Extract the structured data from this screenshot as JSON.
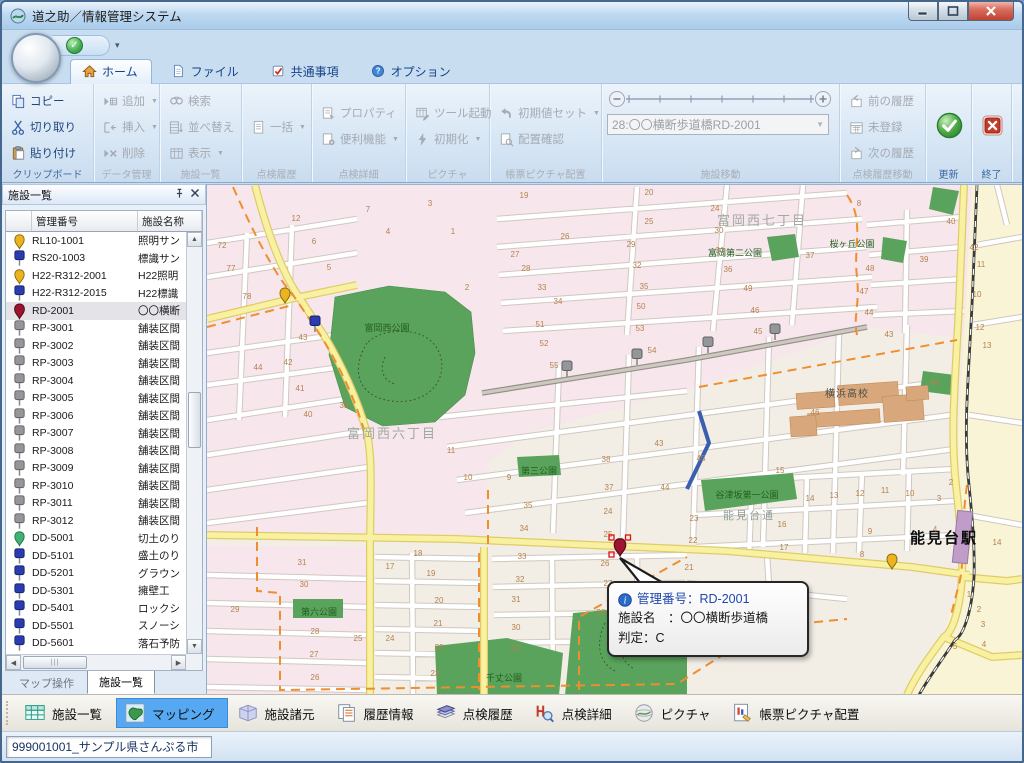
{
  "window": {
    "title": "道之助／情報管理システム"
  },
  "tabs": [
    {
      "label": "ホーム",
      "active": true
    },
    {
      "label": "ファイル",
      "active": false
    },
    {
      "label": "共通事項",
      "active": false
    },
    {
      "label": "オプション",
      "active": false
    }
  ],
  "ribbon": {
    "groups": [
      {
        "label": "クリップボード",
        "enabled": true,
        "buttons": [
          {
            "label": "コピー"
          },
          {
            "label": "切り取り"
          },
          {
            "label": "貼り付け"
          }
        ]
      },
      {
        "label": "データ管理",
        "enabled": false,
        "buttons": [
          {
            "label": "追加",
            "dropdown": true
          },
          {
            "label": "挿入",
            "dropdown": true
          },
          {
            "label": "削除"
          }
        ]
      },
      {
        "label": "施設一覧",
        "enabled": false,
        "buttons": [
          {
            "label": "検索"
          },
          {
            "label": "並べ替え"
          },
          {
            "label": "表示",
            "dropdown": true
          }
        ]
      },
      {
        "label": "点検履歴",
        "enabled": false,
        "buttons": [
          {
            "label": "一括",
            "dropdown": true
          }
        ]
      },
      {
        "label": "点検詳細",
        "enabled": false,
        "buttons": [
          {
            "label": "プロパティ"
          },
          {
            "label": "便利機能",
            "dropdown": true
          }
        ]
      },
      {
        "label": "ピクチャ",
        "enabled": false,
        "buttons": [
          {
            "label": "ツール起動"
          },
          {
            "label": "初期化",
            "dropdown": true
          }
        ]
      },
      {
        "label": "帳票ピクチャ配置",
        "enabled": false,
        "buttons": [
          {
            "label": "初期値セット",
            "dropdown": true
          },
          {
            "label": "配置確認"
          }
        ]
      },
      {
        "label": "施設移動",
        "enabled": false,
        "combo_value": "28:〇〇横断歩道橋RD-2001"
      },
      {
        "label": "点検履歴移動",
        "enabled": false,
        "buttons": [
          {
            "label": "前の履歴"
          },
          {
            "label": "未登録"
          },
          {
            "label": "次の履歴"
          }
        ]
      },
      {
        "label": "更新",
        "enabled": true
      },
      {
        "label": "終了",
        "enabled": true
      }
    ]
  },
  "facility_panel": {
    "title": "施設一覧",
    "columns": [
      "",
      "管理番号",
      "施設名称"
    ],
    "rows": [
      {
        "id": "RL10-1001",
        "name": "照明サン",
        "icon": "pin-yellow",
        "selected": false
      },
      {
        "id": "RS20-1003",
        "name": "標識サン",
        "icon": "marker-blue",
        "selected": false
      },
      {
        "id": "H22-R312-2001",
        "name": "H22照明",
        "icon": "pin-yellow",
        "selected": false
      },
      {
        "id": "H22-R312-2015",
        "name": "H22標識",
        "icon": "marker-blue",
        "selected": false
      },
      {
        "id": "RD-2001",
        "name": "〇〇横断",
        "icon": "pin-red",
        "selected": true
      },
      {
        "id": "RP-3001",
        "name": "舗装区間",
        "icon": "marker-gray",
        "selected": false
      },
      {
        "id": "RP-3002",
        "name": "舗装区間",
        "icon": "marker-gray",
        "selected": false
      },
      {
        "id": "RP-3003",
        "name": "舗装区間",
        "icon": "marker-gray",
        "selected": false
      },
      {
        "id": "RP-3004",
        "name": "舗装区間",
        "icon": "marker-gray",
        "selected": false
      },
      {
        "id": "RP-3005",
        "name": "舗装区間",
        "icon": "marker-gray",
        "selected": false
      },
      {
        "id": "RP-3006",
        "name": "舗装区間",
        "icon": "marker-gray",
        "selected": false
      },
      {
        "id": "RP-3007",
        "name": "舗装区間",
        "icon": "marker-gray",
        "selected": false
      },
      {
        "id": "RP-3008",
        "name": "舗装区間",
        "icon": "marker-gray",
        "selected": false
      },
      {
        "id": "RP-3009",
        "name": "舗装区間",
        "icon": "marker-gray",
        "selected": false
      },
      {
        "id": "RP-3010",
        "name": "舗装区間",
        "icon": "marker-gray",
        "selected": false
      },
      {
        "id": "RP-3011",
        "name": "舗装区間",
        "icon": "marker-gray",
        "selected": false
      },
      {
        "id": "RP-3012",
        "name": "舗装区間",
        "icon": "marker-gray",
        "selected": false
      },
      {
        "id": "DD-5001",
        "name": "切土のり",
        "icon": "pin-green",
        "selected": false
      },
      {
        "id": "DD-5101",
        "name": "盛土のり",
        "icon": "marker-blue",
        "selected": false
      },
      {
        "id": "DD-5201",
        "name": "グラウン",
        "icon": "marker-blue",
        "selected": false
      },
      {
        "id": "DD-5301",
        "name": "擁壁工",
        "icon": "marker-blue",
        "selected": false
      },
      {
        "id": "DD-5401",
        "name": "ロックシ",
        "icon": "marker-blue",
        "selected": false
      },
      {
        "id": "DD-5501",
        "name": "スノーシ",
        "icon": "marker-blue",
        "selected": false
      },
      {
        "id": "DD-5601",
        "name": "落石予防",
        "icon": "marker-blue",
        "selected": false
      }
    ],
    "tabs": [
      {
        "label": "マップ操作",
        "active": false
      },
      {
        "label": "施設一覧",
        "active": true
      }
    ]
  },
  "map": {
    "labels": [
      {
        "text": "富岡西七丁目",
        "x": 555,
        "y": 40,
        "cls": "district"
      },
      {
        "text": "富岡第二公園",
        "x": 528,
        "y": 71,
        "cls": "park"
      },
      {
        "text": "桜ヶ丘公園",
        "x": 645,
        "y": 62,
        "cls": "park"
      },
      {
        "text": "富岡西公園",
        "x": 180,
        "y": 146,
        "cls": "park"
      },
      {
        "text": "富岡西六丁目",
        "x": 185,
        "y": 253,
        "cls": "district"
      },
      {
        "text": "横浜高校",
        "x": 640,
        "y": 212,
        "cls": "school"
      },
      {
        "text": "谷津坂第一公園",
        "x": 540,
        "y": 313,
        "cls": "park"
      },
      {
        "text": "能見台通",
        "x": 542,
        "y": 334,
        "cls": "road"
      },
      {
        "text": "能見台駅",
        "x": 737,
        "y": 358,
        "cls": "station"
      },
      {
        "text": "第三公園",
        "x": 332,
        "y": 289,
        "cls": "park"
      },
      {
        "text": "第六公園",
        "x": 112,
        "y": 430,
        "cls": "park"
      },
      {
        "text": "千丈公園",
        "x": 297,
        "y": 496,
        "cls": "park"
      }
    ],
    "block_numbers": [
      [
        12,
        89,
        36
      ],
      [
        7,
        161,
        27
      ],
      [
        3,
        223,
        21
      ],
      [
        6,
        107,
        59
      ],
      [
        4,
        181,
        49
      ],
      [
        1,
        246,
        49
      ],
      [
        5,
        122,
        85
      ],
      [
        2,
        260,
        105
      ],
      [
        72,
        15,
        63
      ],
      [
        77,
        24,
        86
      ],
      [
        78,
        40,
        114
      ],
      [
        43,
        96,
        155
      ],
      [
        42,
        81,
        180
      ],
      [
        44,
        51,
        185
      ],
      [
        41,
        93,
        206
      ],
      [
        40,
        101,
        232
      ],
      [
        39,
        137,
        223
      ],
      [
        19,
        317,
        13
      ],
      [
        26,
        358,
        54
      ],
      [
        27,
        308,
        72
      ],
      [
        28,
        319,
        86
      ],
      [
        33,
        335,
        105
      ],
      [
        34,
        351,
        119
      ],
      [
        51,
        333,
        142
      ],
      [
        52,
        337,
        161
      ],
      [
        55,
        347,
        183
      ],
      [
        20,
        442,
        10
      ],
      [
        24,
        508,
        26
      ],
      [
        25,
        442,
        39
      ],
      [
        30,
        512,
        48
      ],
      [
        29,
        424,
        62
      ],
      [
        31,
        513,
        68
      ],
      [
        32,
        430,
        83
      ],
      [
        36,
        521,
        87
      ],
      [
        35,
        437,
        104
      ],
      [
        49,
        541,
        106
      ],
      [
        50,
        434,
        124
      ],
      [
        46,
        548,
        128
      ],
      [
        53,
        433,
        146
      ],
      [
        45,
        551,
        149
      ],
      [
        54,
        445,
        168
      ],
      [
        37,
        603,
        73
      ],
      [
        48,
        663,
        86
      ],
      [
        47,
        657,
        109
      ],
      [
        44,
        662,
        130
      ],
      [
        43,
        682,
        152
      ],
      [
        8,
        652,
        21
      ],
      [
        40,
        744,
        39
      ],
      [
        39,
        717,
        77
      ],
      [
        42,
        767,
        65
      ],
      [
        38,
        399,
        277
      ],
      [
        37,
        402,
        305
      ],
      [
        24,
        401,
        329
      ],
      [
        25,
        401,
        352
      ],
      [
        26,
        398,
        381
      ],
      [
        35,
        321,
        323
      ],
      [
        34,
        317,
        346
      ],
      [
        33,
        315,
        374
      ],
      [
        44,
        458,
        305
      ],
      [
        45,
        494,
        276
      ],
      [
        23,
        487,
        336
      ],
      [
        22,
        486,
        358
      ],
      [
        21,
        482,
        385
      ],
      [
        43,
        452,
        261
      ],
      [
        10,
        261,
        295
      ],
      [
        9,
        302,
        295
      ],
      [
        11,
        244,
        268
      ],
      [
        15,
        573,
        288
      ],
      [
        14,
        603,
        316
      ],
      [
        13,
        627,
        313
      ],
      [
        12,
        653,
        311
      ],
      [
        11,
        678,
        308
      ],
      [
        10,
        703,
        311
      ],
      [
        3,
        732,
        316
      ],
      [
        16,
        575,
        342
      ],
      [
        9,
        663,
        349
      ],
      [
        17,
        577,
        365
      ],
      [
        8,
        655,
        372
      ],
      [
        4,
        728,
        347
      ],
      [
        46,
        608,
        230
      ],
      [
        48,
        728,
        200
      ],
      [
        14,
        790,
        360
      ],
      [
        31,
        95,
        380
      ],
      [
        30,
        97,
        402
      ],
      [
        29,
        28,
        427
      ],
      [
        28,
        108,
        449
      ],
      [
        27,
        107,
        472
      ],
      [
        26,
        108,
        495
      ],
      [
        17,
        183,
        384
      ],
      [
        18,
        211,
        371
      ],
      [
        19,
        224,
        391
      ],
      [
        20,
        232,
        418
      ],
      [
        21,
        231,
        441
      ],
      [
        22,
        232,
        465
      ],
      [
        23,
        228,
        491
      ],
      [
        25,
        151,
        456
      ],
      [
        24,
        183,
        456
      ],
      [
        32,
        313,
        397
      ],
      [
        31,
        309,
        417
      ],
      [
        30,
        309,
        445
      ],
      [
        29,
        308,
        466
      ],
      [
        27,
        401,
        401
      ],
      [
        28,
        394,
        430
      ],
      [
        1,
        762,
        412
      ],
      [
        2,
        772,
        427
      ],
      [
        3,
        776,
        442
      ],
      [
        5,
        748,
        464
      ],
      [
        4,
        777,
        462
      ],
      [
        12,
        773,
        145
      ],
      [
        13,
        780,
        163
      ],
      [
        11,
        774,
        82
      ],
      [
        10,
        770,
        112
      ],
      [
        2,
        744,
        300
      ]
    ],
    "markers": [
      {
        "type": "pin-yellow",
        "x": 78,
        "y": 118
      },
      {
        "type": "marker-blue",
        "x": 108,
        "y": 147
      },
      {
        "type": "marker-gray",
        "x": 360,
        "y": 192
      },
      {
        "type": "marker-gray",
        "x": 430,
        "y": 180
      },
      {
        "type": "marker-gray",
        "x": 501,
        "y": 168
      },
      {
        "type": "marker-gray",
        "x": 568,
        "y": 155
      },
      {
        "type": "marker-red-selected",
        "x": 413,
        "y": 371
      },
      {
        "type": "pin-yellow",
        "x": 685,
        "y": 384
      }
    ],
    "tooltip": {
      "title": "管理番号：RD-2001",
      "facility": "施設名　：〇〇横断歩道橋",
      "rating": "判定：C"
    }
  },
  "bottom_toolbar": [
    {
      "label": "施設一覧",
      "icon": "btgrid",
      "active": false
    },
    {
      "label": "マッピング",
      "icon": "btmap",
      "active": true
    },
    {
      "label": "施設諸元",
      "icon": "btbook",
      "active": false
    },
    {
      "label": "履歴情報",
      "icon": "bthistory",
      "active": false
    },
    {
      "label": "点検履歴",
      "icon": "btbooks",
      "active": false
    },
    {
      "label": "点検詳細",
      "icon": "btdetail",
      "active": false
    },
    {
      "label": "ピクチャ",
      "icon": "btpicture",
      "active": false
    },
    {
      "label": "帳票ピクチャ配置",
      "icon": "btreport",
      "active": false
    }
  ],
  "status_bar": {
    "text": "999001001_サンプル県さんぷる市"
  }
}
